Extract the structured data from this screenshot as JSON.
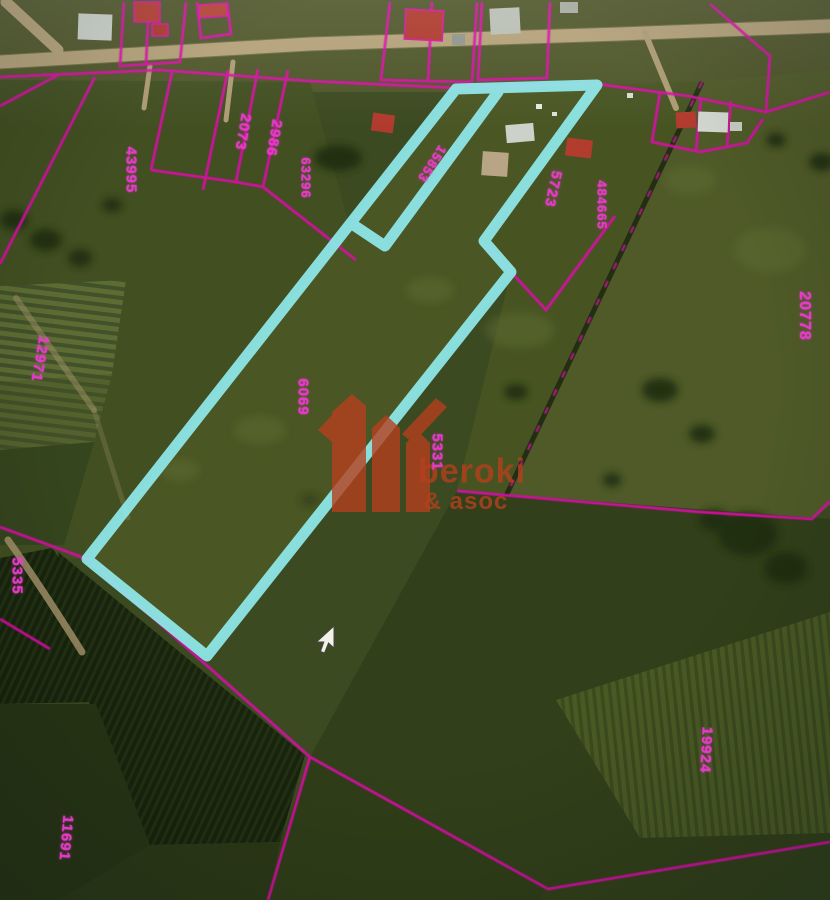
{
  "map": {
    "watermark": {
      "brand": "beroki",
      "suffix": "& asoc"
    },
    "colors": {
      "selection_outline": "#8fe9ec",
      "boundary_lines": "#d911a6",
      "parcel_label_text": "#e838cc",
      "watermark_orange": "#b5401d",
      "road_tan": "#b2a077"
    },
    "parcel_labels": [
      {
        "id": "parcel-43995",
        "text": "43995"
      },
      {
        "id": "parcel-2073",
        "text": "2073"
      },
      {
        "id": "parcel-2986",
        "text": "2986"
      },
      {
        "id": "parcel-63296",
        "text": "63296"
      },
      {
        "id": "parcel-15853",
        "text": "15853"
      },
      {
        "id": "parcel-5723",
        "text": "5723"
      },
      {
        "id": "parcel-484665",
        "text": "484665"
      },
      {
        "id": "parcel-20778",
        "text": "20778"
      },
      {
        "id": "parcel-12971",
        "text": "12971"
      },
      {
        "id": "parcel-6069",
        "text": "6069"
      },
      {
        "id": "parcel-5331",
        "text": "5331"
      },
      {
        "id": "parcel-5335",
        "text": "5335"
      },
      {
        "id": "parcel-11691",
        "text": "11691"
      },
      {
        "id": "parcel-19924",
        "text": "19924"
      }
    ]
  }
}
